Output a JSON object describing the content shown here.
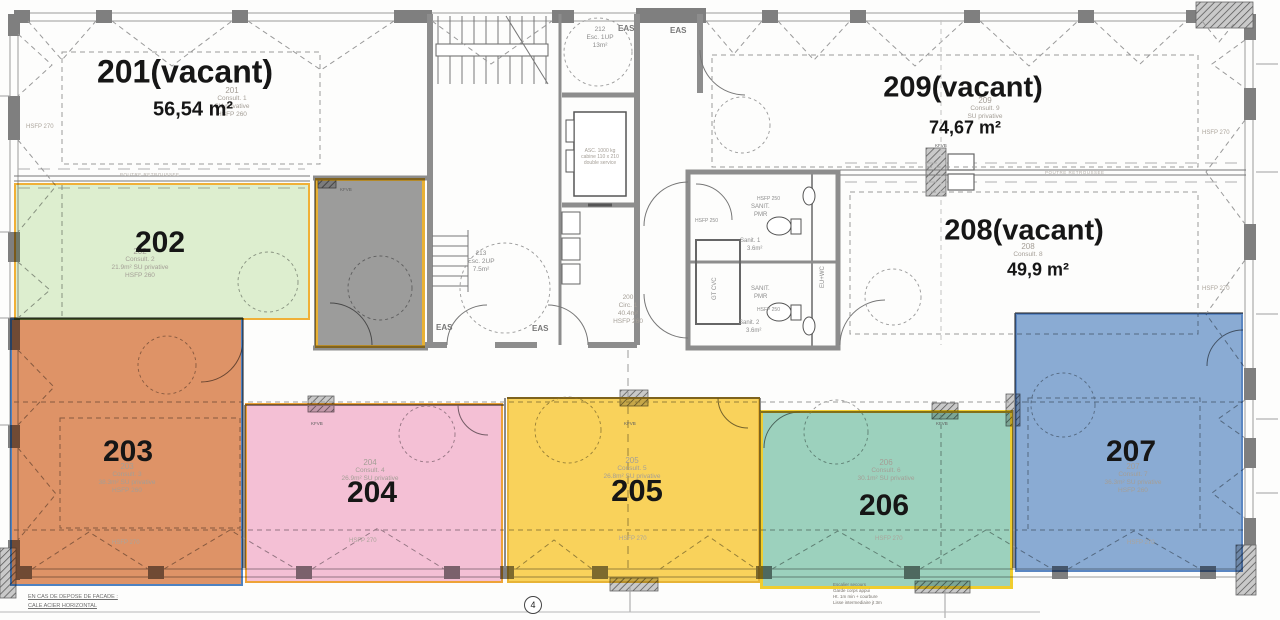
{
  "plan": {
    "axis_marker": "4",
    "units": {
      "u201": {
        "label": "201(vacant)",
        "area": "56,54 m²",
        "num": "201",
        "type": "Consult. 1",
        "priv": "SU privative",
        "hsfp": "HSFP 260"
      },
      "u202": {
        "label": "202",
        "num": "202",
        "type": "Consult. 2",
        "priv": "21.9m² SU privative",
        "hsfp": "HSFP 260"
      },
      "u203": {
        "label": "203",
        "num": "203",
        "type": "Consult. 3",
        "priv": "38.3m² SU privative",
        "hsfp": "HSFP 260",
        "hsfp270": "HSFP 270"
      },
      "u204": {
        "label": "204",
        "num": "204",
        "type": "Consult. 4",
        "priv": "26.9m² SU privative",
        "hsfp270": "HSFP 270"
      },
      "u205": {
        "label": "205",
        "num": "205",
        "type": "Consult. 5",
        "priv": "26.8m² SU privative",
        "hsfp270": "HSFP 270"
      },
      "u206": {
        "label": "206",
        "num": "206",
        "type": "Consult. 6",
        "priv": "30.1m² SU privative",
        "hsfp270": "HSFP 270"
      },
      "u207": {
        "label": "207",
        "num": "207",
        "type": "Consult. 7",
        "priv": "36.3m² SU privative",
        "hsfp": "HSFP 260",
        "hsfp270": "HSFP 270"
      },
      "u208": {
        "label": "208(vacant)",
        "area": "49,9 m²",
        "num": "208",
        "type": "Consult. 8"
      },
      "u209": {
        "label": "209(vacant)",
        "area": "74,67 m²",
        "num": "209",
        "type": "Consult. 9",
        "priv": "SU privative"
      }
    },
    "core": {
      "corridor": {
        "num": "200",
        "type": "Circ. 1",
        "area": "40.4m²",
        "hsfp": "HSFP 260"
      },
      "stair1": {
        "num": "212",
        "type": "Esc. 1UP",
        "area": "13m²"
      },
      "stair2": {
        "num": "213",
        "type": "Esc. 2UP",
        "area": "7.5m²"
      },
      "elevator": {
        "l1": "ASC. 1000 kg",
        "l2": "cabine 110 x 210",
        "l3": "double service"
      },
      "eas": "EAS",
      "sanit1": {
        "t1": "SANIT.",
        "t2": "PMR",
        "name": "Sanit. 1",
        "area": "3.6m²"
      },
      "sanit2": {
        "t1": "SANIT.",
        "t2": "PMR",
        "name": "Sanit. 2",
        "area": "3.6m²"
      },
      "gt_cvc": "GT CVC",
      "eu_wc": "EU+WC",
      "hsfp250": "HSFP 250"
    },
    "misc": {
      "hsfp270": "HSFP 270",
      "kfvb": "KFVB",
      "poutre": "POUTRE RETROUSSEE",
      "note_left_1": "EN CAS DE DEPOSE DE FACADE :",
      "note_left_2": "CALE ACIER HORIZONTAL",
      "note_right_1": "Escalier secours",
      "note_right_2": "Garde corps appui",
      "note_right_3": "Ht. 1m min + courbure",
      "note_right_4": "Lisse intermediaire jt 3m"
    }
  }
}
